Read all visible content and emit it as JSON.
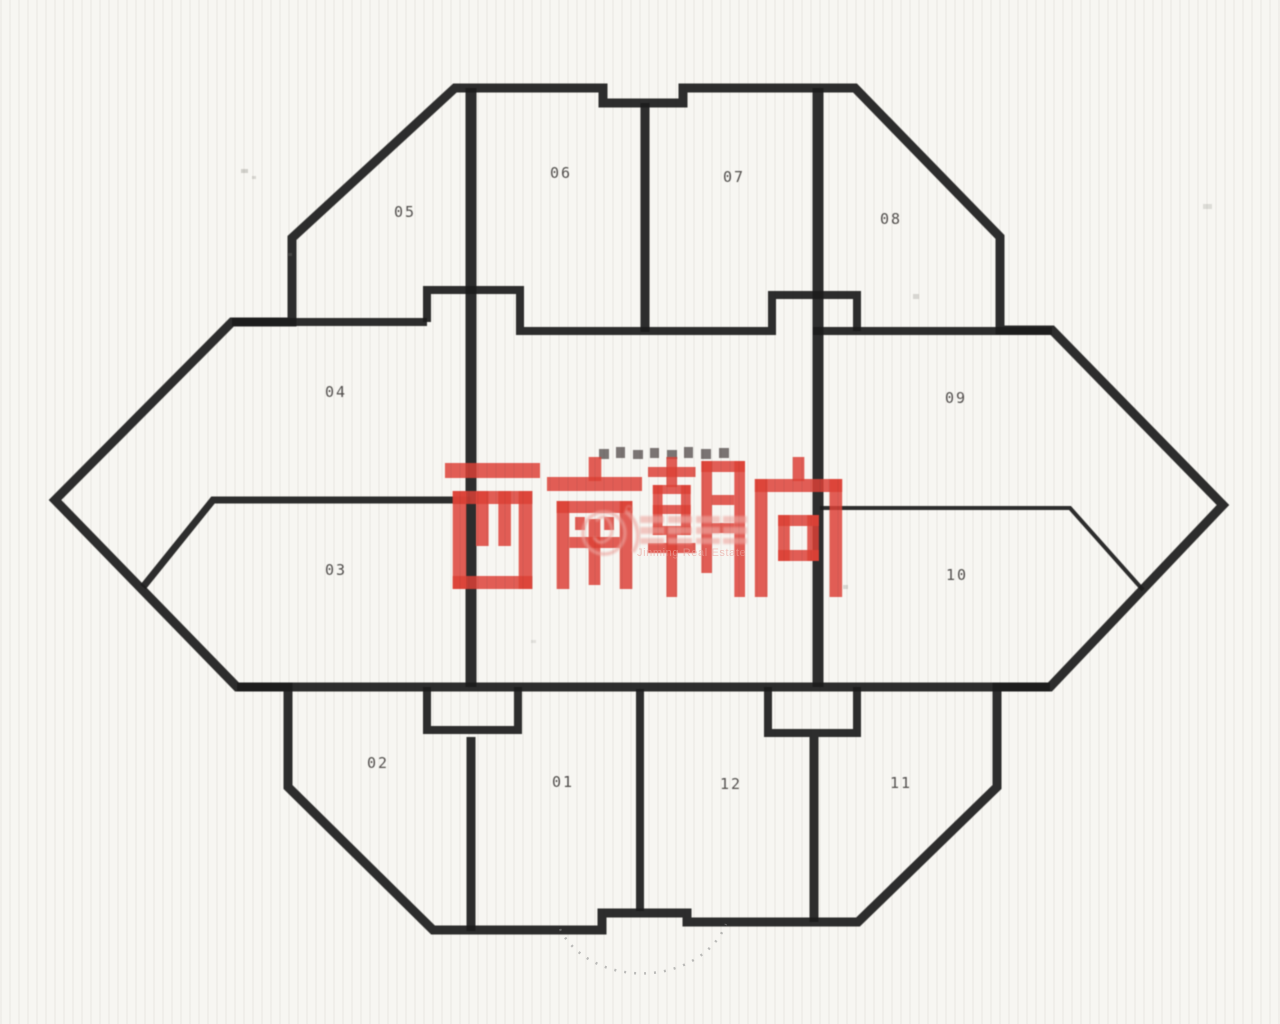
{
  "page": {
    "title": "西南朝向 户型平面图 (scanned floor plate)",
    "background": "#f7f6f2"
  },
  "overlay": {
    "text": "西南朝向",
    "color": "#dd4036"
  },
  "watermark": {
    "brand_cn": "锦明地产",
    "brand_en": "Jinming Real Estate",
    "logo": "swan-in-circle",
    "color": "#eda49e"
  },
  "core": {
    "label": "电梯大堂及公共区"
  },
  "units": [
    {
      "label": "01"
    },
    {
      "label": "02"
    },
    {
      "label": "03"
    },
    {
      "label": "04"
    },
    {
      "label": "05"
    },
    {
      "label": "06"
    },
    {
      "label": "07"
    },
    {
      "label": "08"
    },
    {
      "label": "09"
    },
    {
      "label": "10"
    },
    {
      "label": "11"
    },
    {
      "label": "12"
    }
  ],
  "colors": {
    "wall": "#1b1b1b",
    "overlay_red": "#dd4036",
    "watermark_pink": "#eda49e",
    "paper": "#f7f6f2"
  }
}
